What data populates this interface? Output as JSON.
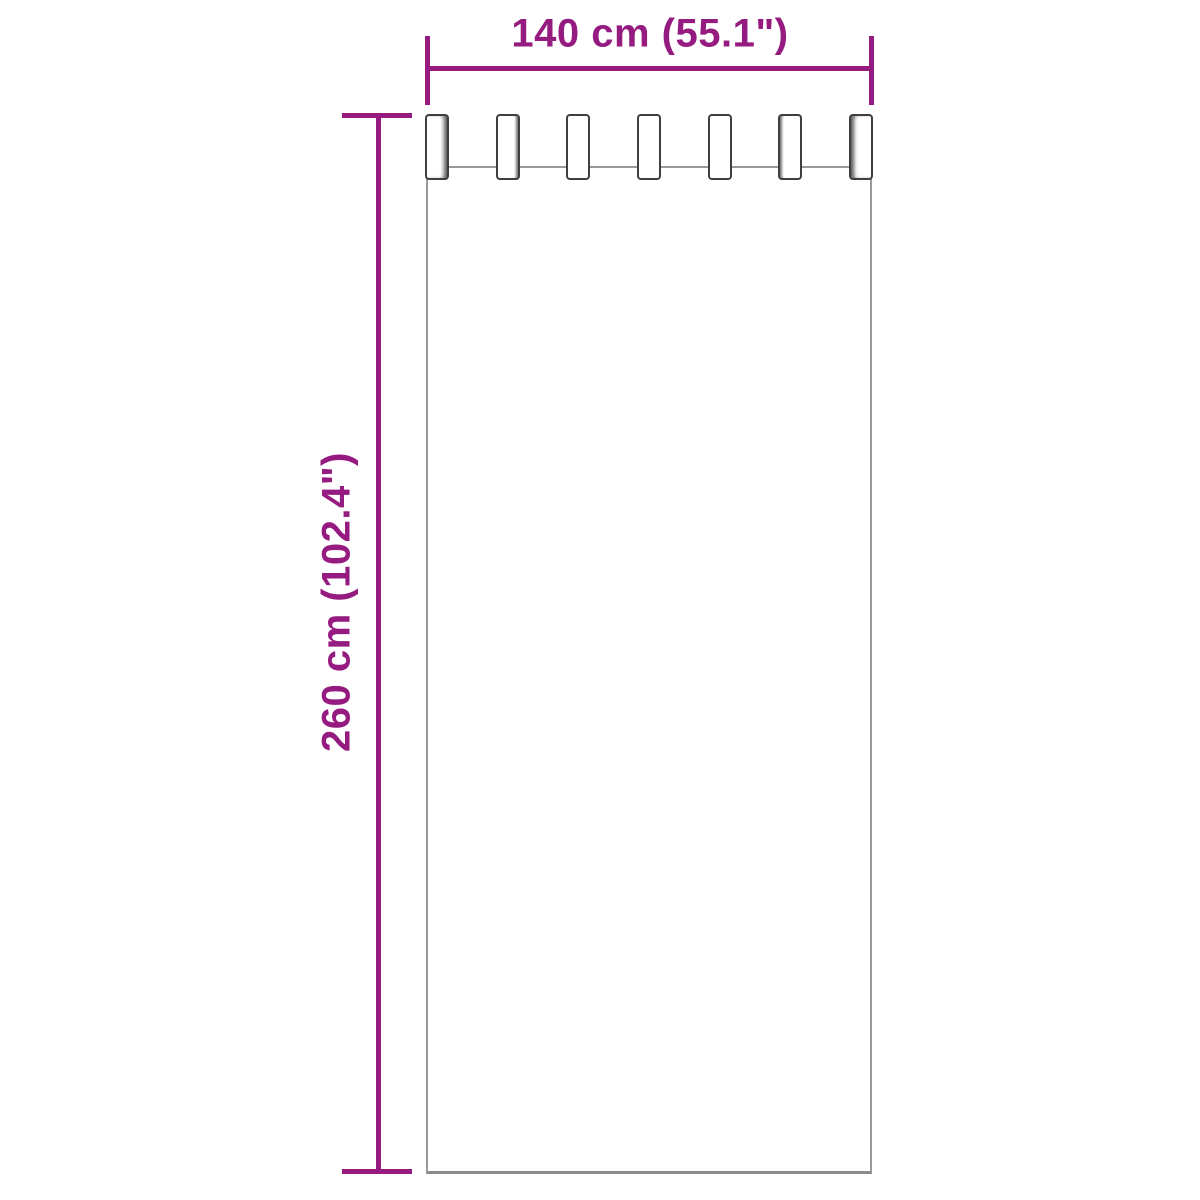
{
  "page": {
    "background_color": "#ffffff"
  },
  "diagram": {
    "type": "product-dimension-diagram",
    "subject": "tab-top curtain panel",
    "accent_color": "#951b81",
    "curtain_outline_color": "#9a9a9a",
    "curtain_bottom_outline_color": "#8a8a8a",
    "tab_outline_color": "#3f3f3f",
    "tab_count": 7,
    "width_dimension": {
      "label": "140 cm (55.1\")",
      "value_cm": 140,
      "value_inches": 55.1
    },
    "height_dimension": {
      "label": "260 cm (102.4\")",
      "value_cm": 260,
      "value_inches": 102.4
    }
  }
}
